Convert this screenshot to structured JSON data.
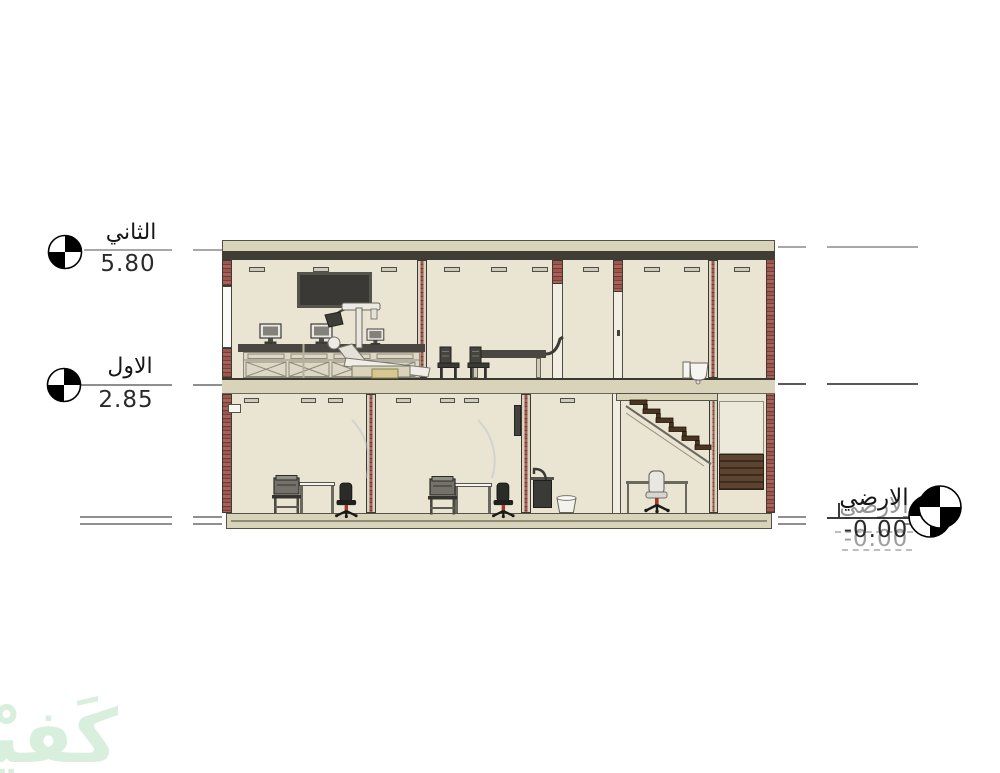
{
  "section": {
    "levels": [
      {
        "name": "الثاني",
        "elevation": "5.80"
      },
      {
        "name": "الاول",
        "elevation": "2.85"
      },
      {
        "name": "الارضي",
        "elevation": "-0.00"
      }
    ],
    "watermark": {
      "text": "كَفيْل",
      "color": "#d8efdd"
    },
    "colors": {
      "interior_wall": "#e9e5d2",
      "slab": "#d9d3ba",
      "brick": "#9d564c",
      "roof_band": "#3f3d36",
      "level_line_gray": "#a8a8a8"
    }
  }
}
